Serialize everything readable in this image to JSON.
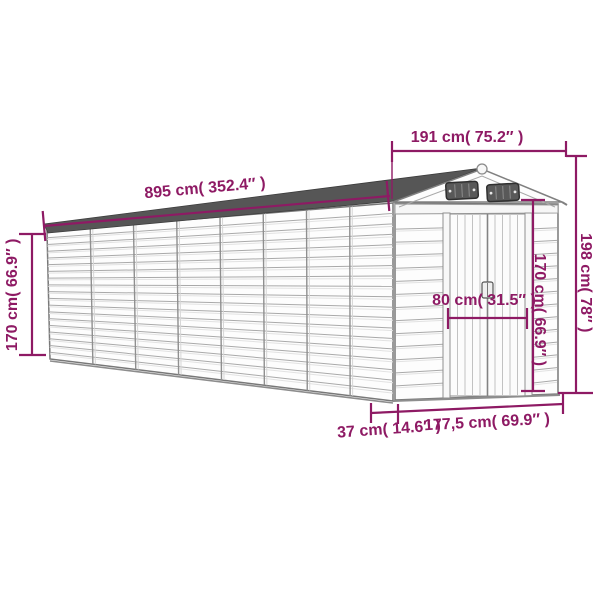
{
  "diagram": {
    "title": "garden-shed-dimension-diagram",
    "accent_color": "#8E1A64",
    "dimensions": {
      "top_width": "191 cm( 75.2″ )",
      "roof_length": "895 cm( 352.4″ )",
      "rear_wall_height": "170 cm( 66.9″ )",
      "front_height": "198 cm( 78″ )",
      "door_height": "170 cm( 66.9″ )",
      "door_width": "80 cm( 31.5″ )",
      "base_front_width": "177,5 cm( 69.9″ )",
      "base_side_offset": "37 cm( 14.6″ )"
    }
  }
}
